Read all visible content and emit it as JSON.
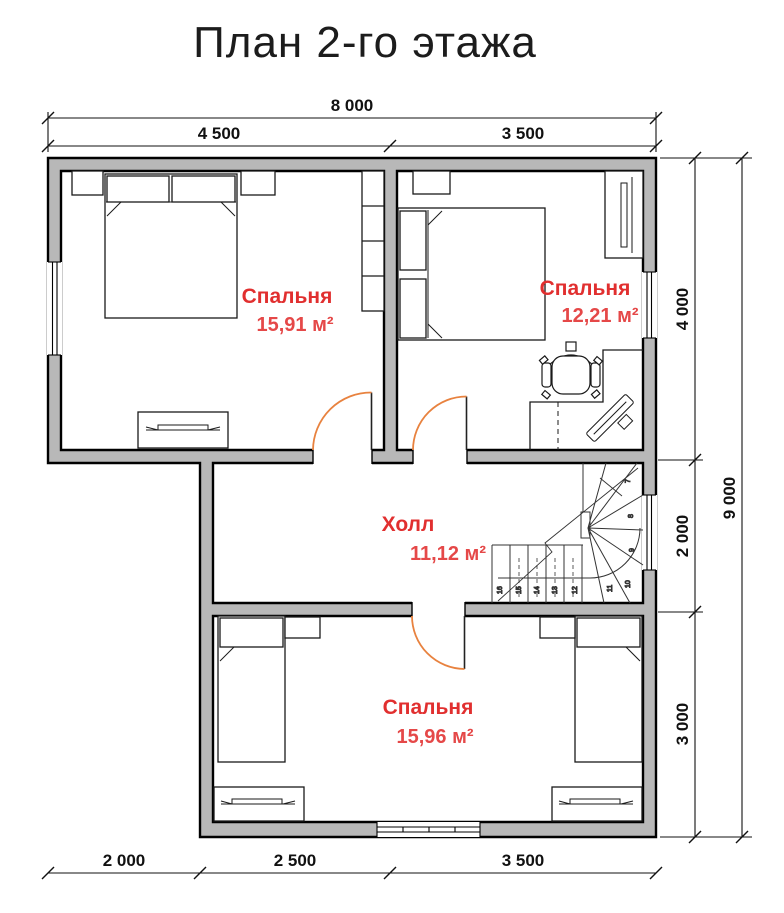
{
  "title": "План 2-го этажа",
  "rooms": {
    "bedroom1": {
      "name": "Спальня",
      "area": "15,91 м²"
    },
    "bedroom2": {
      "name": "Спальня",
      "area": "12,21 м²"
    },
    "hall": {
      "name": "Холл",
      "area": "11,12 м²"
    },
    "bedroom3": {
      "name": "Спальня",
      "area": "15,96 м²"
    }
  },
  "dimensions": {
    "top_total": "8 000",
    "top_left": "4 500",
    "top_right": "3 500",
    "right_top": "4 000",
    "right_mid": "2 000",
    "right_bottom": "3 000",
    "right_total": "9 000",
    "bottom_left": "2 000",
    "bottom_mid": "2 500",
    "bottom_right": "3 500"
  },
  "stairs": {
    "steps": {
      "s7": "7",
      "s8": "8",
      "s9": "9",
      "s10": "10",
      "s11": "11",
      "s12": "12",
      "s13": "13",
      "s14": "14",
      "s15": "15",
      "s16": "16"
    }
  },
  "colors": {
    "wall_fill": "#b8b8b8",
    "outline": "#000000",
    "room_label_red": "#e12f2f",
    "door_arc_orange": "#e8823f"
  }
}
